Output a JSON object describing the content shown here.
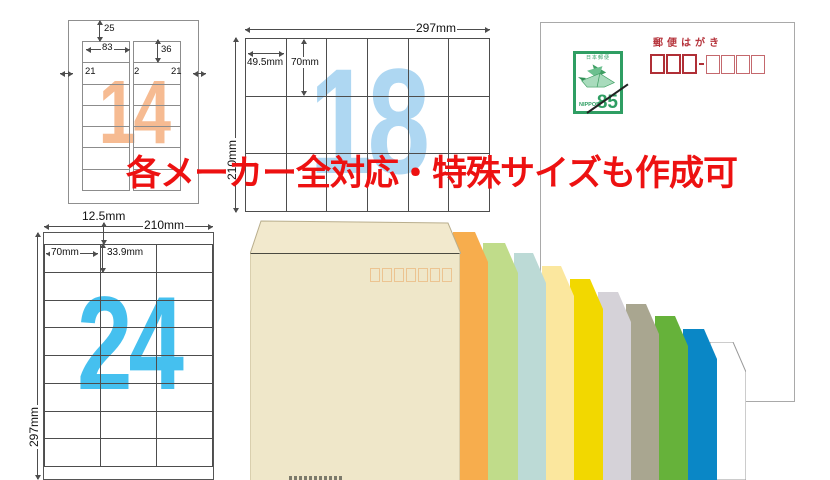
{
  "banner": {
    "text": "各メーカー全対応・特殊サイズも作成可",
    "color": "#ed1111"
  },
  "sheets": {
    "s14": {
      "count": "14",
      "watermark_color": "#f6bb92",
      "cols": 2,
      "rows": 7,
      "dims": {
        "top_margin": "25",
        "label_width": "83",
        "label_height": "36",
        "left_margin": "21",
        "column_gap": "2",
        "right_margin": "21"
      }
    },
    "s18": {
      "count": "18",
      "watermark_color": "#aed7f2",
      "cols": 6,
      "rows": 3,
      "dims": {
        "page_width": "297mm",
        "label_width": "49.5mm",
        "label_height": "70mm",
        "page_height": "210mm"
      }
    },
    "s24": {
      "count": "24",
      "watermark_color": "#45c0ef",
      "cols": 3,
      "rows": 8,
      "dims": {
        "top_margin": "12.5mm",
        "page_width": "210mm",
        "label_width": "70mm",
        "label_height": "33.9mm",
        "page_height": "297mm"
      }
    }
  },
  "postcard": {
    "title": "郵便はがき",
    "zip_box_count": 7,
    "stamp": {
      "issuer": "日本郵便",
      "country": "NIPPON",
      "value": "85"
    }
  },
  "envelopes": {
    "front": {
      "name": "kraft-cream",
      "hex": "#efe7c9"
    },
    "stack": [
      {
        "name": "white",
        "hex": "#ffffff"
      },
      {
        "name": "blue",
        "hex": "#0a87c6"
      },
      {
        "name": "green",
        "hex": "#66b23a"
      },
      {
        "name": "olive-gray",
        "hex": "#a9a690"
      },
      {
        "name": "light-gray",
        "hex": "#d5d2d8"
      },
      {
        "name": "yellow",
        "hex": "#f2d800"
      },
      {
        "name": "cream-yellow",
        "hex": "#fbe79e"
      },
      {
        "name": "pale-blue",
        "hex": "#bcdad6"
      },
      {
        "name": "yellow-green",
        "hex": "#c0dc8a"
      },
      {
        "name": "orange",
        "hex": "#f7ad4d"
      }
    ]
  }
}
